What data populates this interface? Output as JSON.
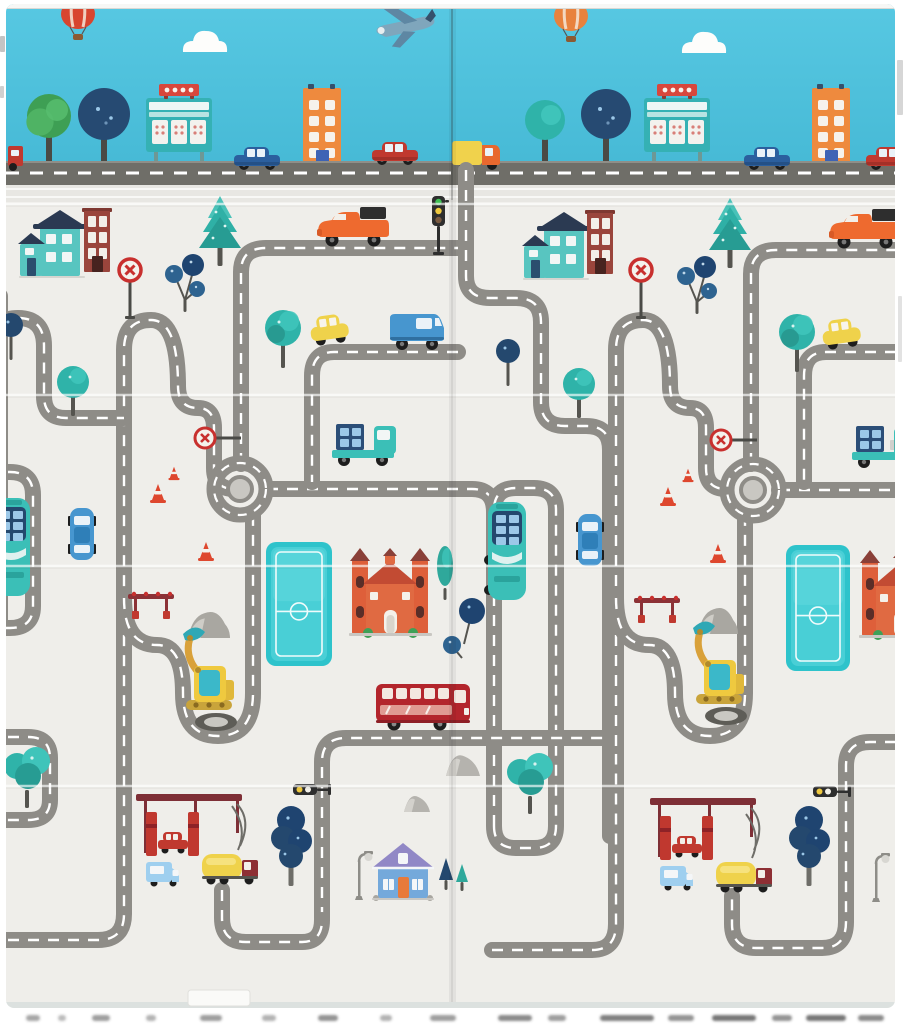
{
  "meta": {
    "kind": "photo-of-kids-road-playmat",
    "width": 908,
    "height": 1024
  },
  "palette": {
    "sky": "#4CC0DC",
    "band_road": "#6F6E68",
    "mat_bg": "#EFEEEA",
    "seam": "#E8E7E3",
    "road": "#8E8C87",
    "dash": "#FFFFFF",
    "hub": "#C9C7C2",
    "teal": "#3BBFB7",
    "teal_dark": "#279C93",
    "navy": "#24486E",
    "navy_tree": "#1F4470",
    "green": "#3EA057",
    "orange": "#EE8A3E",
    "orange_car": "#EE6A2F",
    "red": "#C0392F",
    "dark_red": "#B3252C",
    "maroon": "#7E2F36",
    "yellow": "#EFD24B",
    "excavator_yellow": "#EFC93F",
    "blue": "#4796CF",
    "light_blue": "#9FCFEF",
    "window": "#F2F6F5",
    "purple_roof": "#9188C6",
    "field": "#2EC3CB",
    "field_inner": "#49CFD6",
    "edge_strip": "#DCE1DF"
  },
  "mat": {
    "x": 6,
    "y": 4,
    "w": 889,
    "h": 1004,
    "fold_x": 452,
    "creases_y": [
      204,
      395,
      566,
      786
    ],
    "sky_bottom": 161,
    "band_road_y": 161,
    "band_road_h": 24,
    "seam_y": 185,
    "seam_h": 17,
    "bottom_strip_y": 1002
  },
  "band": {
    "balloons": [
      {
        "x": 78,
        "y": 6,
        "color": "#D8452F"
      },
      {
        "x": 571,
        "y": 8,
        "color": "#E8823D"
      }
    ],
    "clouds": [
      {
        "x": 205,
        "y": 44
      },
      {
        "x": 704,
        "y": 45
      }
    ],
    "airplane": {
      "x": 405,
      "y": 28
    },
    "trees": [
      {
        "kind": "roundGreen",
        "x": 49,
        "cy": 116,
        "r": 22
      },
      {
        "kind": "roundNavy",
        "x": 104,
        "cy": 114,
        "r": 26
      },
      {
        "kind": "roundTeal",
        "x": 545,
        "cy": 120,
        "r": 20
      },
      {
        "kind": "roundNavy",
        "x": 606,
        "cy": 114,
        "r": 25
      }
    ],
    "billboards": [
      {
        "x": 146,
        "y": 84
      },
      {
        "x": 644,
        "y": 84
      }
    ],
    "buildings": [
      {
        "x": 303,
        "y": 84
      },
      {
        "x": 812,
        "y": 84
      }
    ],
    "vehicles": [
      {
        "kind": "sedan",
        "x": 234,
        "y": 149,
        "color": "#2B5F9E"
      },
      {
        "kind": "sedan",
        "x": 744,
        "y": 149,
        "color": "#2B5F9E"
      },
      {
        "kind": "sedan",
        "x": 372,
        "y": 144,
        "color": "#C0392F"
      },
      {
        "kind": "sedan",
        "x": 866,
        "y": 149,
        "color": "#C0392F"
      },
      {
        "kind": "boxTruck",
        "x": 452,
        "y": 145
      },
      {
        "kind": "redSliver",
        "x": 8,
        "y": 146
      }
    ]
  },
  "main": {
    "roads": [
      "M -12,940 H 98 Q 124,940 124,914 V 350 Q 124,320 151,320 Q 178,320 178,386 Q 178,408 198,408 Q 214,408 214,428 V 468 Q 214,489 234,489",
      "M -8,462 V 346 Q -8,318 18,318 Q 44,318 44,346 V 396 Q 44,418 66,418 H 124",
      "M -12,472 H 10 Q 33,472 33,495 V 606 Q 33,628 10,628 H -12",
      "M -12,737 H 28 Q 50,737 50,758 V 800 Q 50,820 28,820 H -12",
      "M 124,598 Q 124,645 157,645 Q 183,645 183,693 Q 183,736 218,736 Q 253,736 253,693 V 514",
      "M 241,464 V 272 Q 241,248 266,248 H 462",
      "M 267,489 H 472 Q 494,489 494,512",
      "M 494,826 V 510 Q 494,488 516,488 H 534 Q 556,488 556,510 V 826 Q 556,848 534,848 H 516 Q 494,848 494,826 Z",
      "M 466,170 V 276 Q 466,298 490,298 H 516 Q 541,298 541,322 V 402 Q 541,426 565,426 H 586 Q 610,426 610,450 V 836",
      "M 322,918 V 762 Q 322,738 346,738 H 610",
      "M 222,890 V 918 Q 222,942 246,942 H 302 Q 322,942 322,920",
      "M 492,950 H 592 Q 616,950 616,924 V 744",
      "M 616,746 V 350 Q 616,320 643,320 Q 670,320 670,386 Q 670,408 690,408 Q 706,408 706,428 V 468 Q 706,489 726,489",
      "M 616,598 Q 616,645 649,645 Q 675,645 675,693 Q 675,736 710,736 Q 745,736 745,693 V 516",
      "M 751,464 V 274 Q 751,250 776,250 H 916",
      "M 779,490 H 916",
      "M 458,352 H 334 Q 312,352 312,376 V 482",
      "M 916,352 H 826 Q 804,352 804,376 V 482",
      "M 916,742 H 870 Q 846,742 846,766 V 922 Q 846,948 822,948 H 756 Q 732,948 732,924 V 896",
      "M 0,296 V 620"
    ],
    "roundabouts": [
      {
        "cx": 240,
        "cy": 489
      },
      {
        "cx": 753,
        "cy": 490
      }
    ],
    "fields": [
      {
        "x": 266,
        "y": 542,
        "w": 66,
        "h": 124
      },
      {
        "x": 786,
        "y": 545,
        "w": 64,
        "h": 126
      }
    ],
    "buildings": [
      {
        "kind": "tealHouse",
        "x": 20,
        "y": 210
      },
      {
        "kind": "tealHouse",
        "x": 524,
        "y": 212
      },
      {
        "kind": "brick",
        "x": 84,
        "y": 208
      },
      {
        "kind": "brick",
        "x": 587,
        "y": 210
      },
      {
        "kind": "mansion",
        "x": 352,
        "y": 548
      },
      {
        "kind": "mansion",
        "x": 862,
        "y": 550
      },
      {
        "kind": "blueHouse",
        "x": 374,
        "y": 843
      },
      {
        "kind": "gas",
        "x": 136,
        "y": 794
      },
      {
        "kind": "gas",
        "x": 650,
        "y": 798
      }
    ],
    "trees": [
      {
        "kind": "pine",
        "x": 220,
        "y": 196
      },
      {
        "kind": "pine",
        "x": 730,
        "y": 198
      },
      {
        "kind": "berry",
        "x": 185,
        "y": 248
      },
      {
        "kind": "berry",
        "x": 697,
        "y": 250
      },
      {
        "kind": "roundTealM",
        "x": 283,
        "y": 310
      },
      {
        "kind": "roundTealM",
        "x": 797,
        "y": 314
      },
      {
        "kind": "smallTeal",
        "x": 73,
        "y": 366
      },
      {
        "kind": "smallTeal",
        "x": 579,
        "y": 368
      },
      {
        "kind": "navyBall",
        "x": 11,
        "y": 314
      },
      {
        "kind": "navyBall",
        "x": 508,
        "y": 340
      },
      {
        "kind": "navyPair",
        "x": 462,
        "y": 596
      },
      {
        "kind": "fluffyTeal",
        "x": 27,
        "y": 748
      },
      {
        "kind": "fluffyTeal",
        "x": 530,
        "y": 754
      },
      {
        "kind": "navyTallBtm",
        "x": 291,
        "y": 808
      },
      {
        "kind": "navyTallBtm",
        "x": 809,
        "y": 808
      },
      {
        "kind": "cypress",
        "x": 445,
        "y": 546
      },
      {
        "kind": "housePines",
        "x": 446,
        "y": 858
      }
    ],
    "vehicles": [
      {
        "kind": "pickup",
        "x": 316,
        "y": 206
      },
      {
        "kind": "pickup",
        "x": 828,
        "y": 208
      },
      {
        "kind": "tealTruck",
        "x": 330,
        "y": 416
      },
      {
        "kind": "tealTruck",
        "x": 850,
        "y": 418
      },
      {
        "kind": "vanBlue",
        "x": 390,
        "y": 304
      },
      {
        "kind": "yellowCar",
        "x": 308,
        "y": 314
      },
      {
        "kind": "yellowCar",
        "x": 820,
        "y": 318
      },
      {
        "kind": "carVert",
        "x": 70,
        "y": 508
      },
      {
        "kind": "carVert",
        "x": 578,
        "y": 514
      },
      {
        "kind": "busTealV",
        "x": -8,
        "y": 498
      },
      {
        "kind": "busTealV",
        "x": 488,
        "y": 502
      },
      {
        "kind": "busRed",
        "x": 376,
        "y": 680
      },
      {
        "kind": "tanker",
        "x": 202,
        "y": 846
      },
      {
        "kind": "tanker",
        "x": 716,
        "y": 854
      },
      {
        "kind": "washCar",
        "x": 158,
        "y": 832
      },
      {
        "kind": "washCar",
        "x": 672,
        "y": 836
      },
      {
        "kind": "vanSmall",
        "x": 146,
        "y": 862
      },
      {
        "kind": "vanSmall",
        "x": 660,
        "y": 866
      },
      {
        "kind": "excavator",
        "x": 186,
        "y": 634
      },
      {
        "kind": "excavator",
        "x": 696,
        "y": 628
      }
    ],
    "signs": [
      {
        "kind": "stop",
        "x": 130,
        "y": 270
      },
      {
        "kind": "stop",
        "x": 641,
        "y": 270
      },
      {
        "kind": "signH",
        "x": 205,
        "y": 438
      },
      {
        "kind": "signH",
        "x": 721,
        "y": 440
      },
      {
        "kind": "tlV",
        "x": 432,
        "y": 196
      },
      {
        "kind": "tlH",
        "x": 293,
        "y": 784
      },
      {
        "kind": "tlH",
        "x": 813,
        "y": 786
      },
      {
        "kind": "cone",
        "x": 158,
        "y": 500
      },
      {
        "kind": "cone",
        "x": 206,
        "y": 558
      },
      {
        "kind": "cone",
        "x": 174,
        "y": 478,
        "s": 0.7
      },
      {
        "kind": "cone",
        "x": 668,
        "y": 503
      },
      {
        "kind": "cone",
        "x": 718,
        "y": 560
      },
      {
        "kind": "cone",
        "x": 688,
        "y": 480,
        "s": 0.7
      },
      {
        "kind": "barrier",
        "x": 128,
        "y": 594
      },
      {
        "kind": "barrier",
        "x": 634,
        "y": 598
      },
      {
        "kind": "lamp",
        "x": 355,
        "y": 854
      },
      {
        "kind": "lamp",
        "x": 872,
        "y": 856
      }
    ],
    "rocks": [
      {
        "x": 446,
        "y": 750,
        "w": 34,
        "h": 26
      },
      {
        "x": 404,
        "y": 792,
        "w": 26,
        "h": 20
      }
    ],
    "mounds": [
      {
        "x": 188,
        "y": 610,
        "w": 42,
        "h": 28
      },
      {
        "x": 698,
        "y": 606,
        "w": 40,
        "h": 28
      }
    ]
  },
  "bottom": {
    "label": {
      "x": 188,
      "y": 990,
      "w": 62,
      "h": 16
    },
    "smudges": [
      [
        26,
        14,
        0.45
      ],
      [
        58,
        8,
        0.35
      ],
      [
        92,
        18,
        0.5
      ],
      [
        146,
        10,
        0.4
      ],
      [
        200,
        22,
        0.5
      ],
      [
        262,
        14,
        0.4
      ],
      [
        318,
        20,
        0.55
      ],
      [
        380,
        12,
        0.4
      ],
      [
        430,
        26,
        0.5
      ],
      [
        498,
        34,
        0.6
      ],
      [
        548,
        18,
        0.5
      ],
      [
        600,
        54,
        0.65
      ],
      [
        668,
        26,
        0.55
      ],
      [
        712,
        44,
        0.7
      ],
      [
        772,
        20,
        0.55
      ],
      [
        806,
        40,
        0.7
      ],
      [
        858,
        26,
        0.6
      ]
    ]
  },
  "artifacts": [
    {
      "x": 0,
      "y": 36,
      "w": 5,
      "h": 16,
      "o": 0.5
    },
    {
      "x": 0,
      "y": 86,
      "w": 4,
      "h": 12,
      "o": 0.4
    },
    {
      "x": 897,
      "y": 60,
      "w": 6,
      "h": 55,
      "o": 0.35
    },
    {
      "x": 898,
      "y": 296,
      "w": 4,
      "h": 66,
      "o": 0.25
    },
    {
      "x": 890,
      "y": 440,
      "w": 5,
      "h": 10,
      "o": 0.3
    }
  ]
}
